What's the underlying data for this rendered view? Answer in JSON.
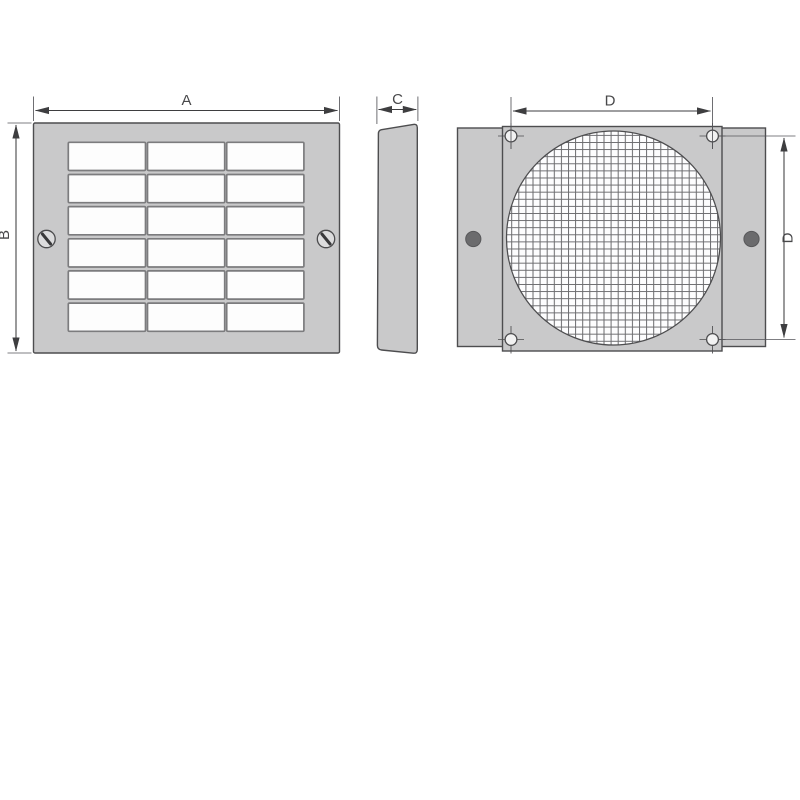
{
  "diagram": {
    "labels": {
      "dim_a": "A",
      "dim_b": "B",
      "dim_c": "C",
      "dim_d_width": "D",
      "dim_d_height": "D"
    },
    "colors": {
      "background": "#ffffff",
      "panel_fill": "#c9c9ca",
      "outline": "#4d4d4f",
      "dimension": "#3e3e40",
      "louver_fill": "#fdfdfd",
      "louver_stroke": "#7c7c7e",
      "mesh_bg": "#fdfdfe",
      "mesh_line": "#6b6b6e",
      "hole_fill": "#f2f2f2",
      "fastener_fill": "#6b6b6d",
      "screw_fill": "#dcdcdd"
    },
    "front_view": {
      "louver_rows": 6,
      "louver_cols": 3,
      "screw_count": 2
    },
    "back_view": {
      "corner_hole_count": 4,
      "fastener_count": 2
    }
  }
}
